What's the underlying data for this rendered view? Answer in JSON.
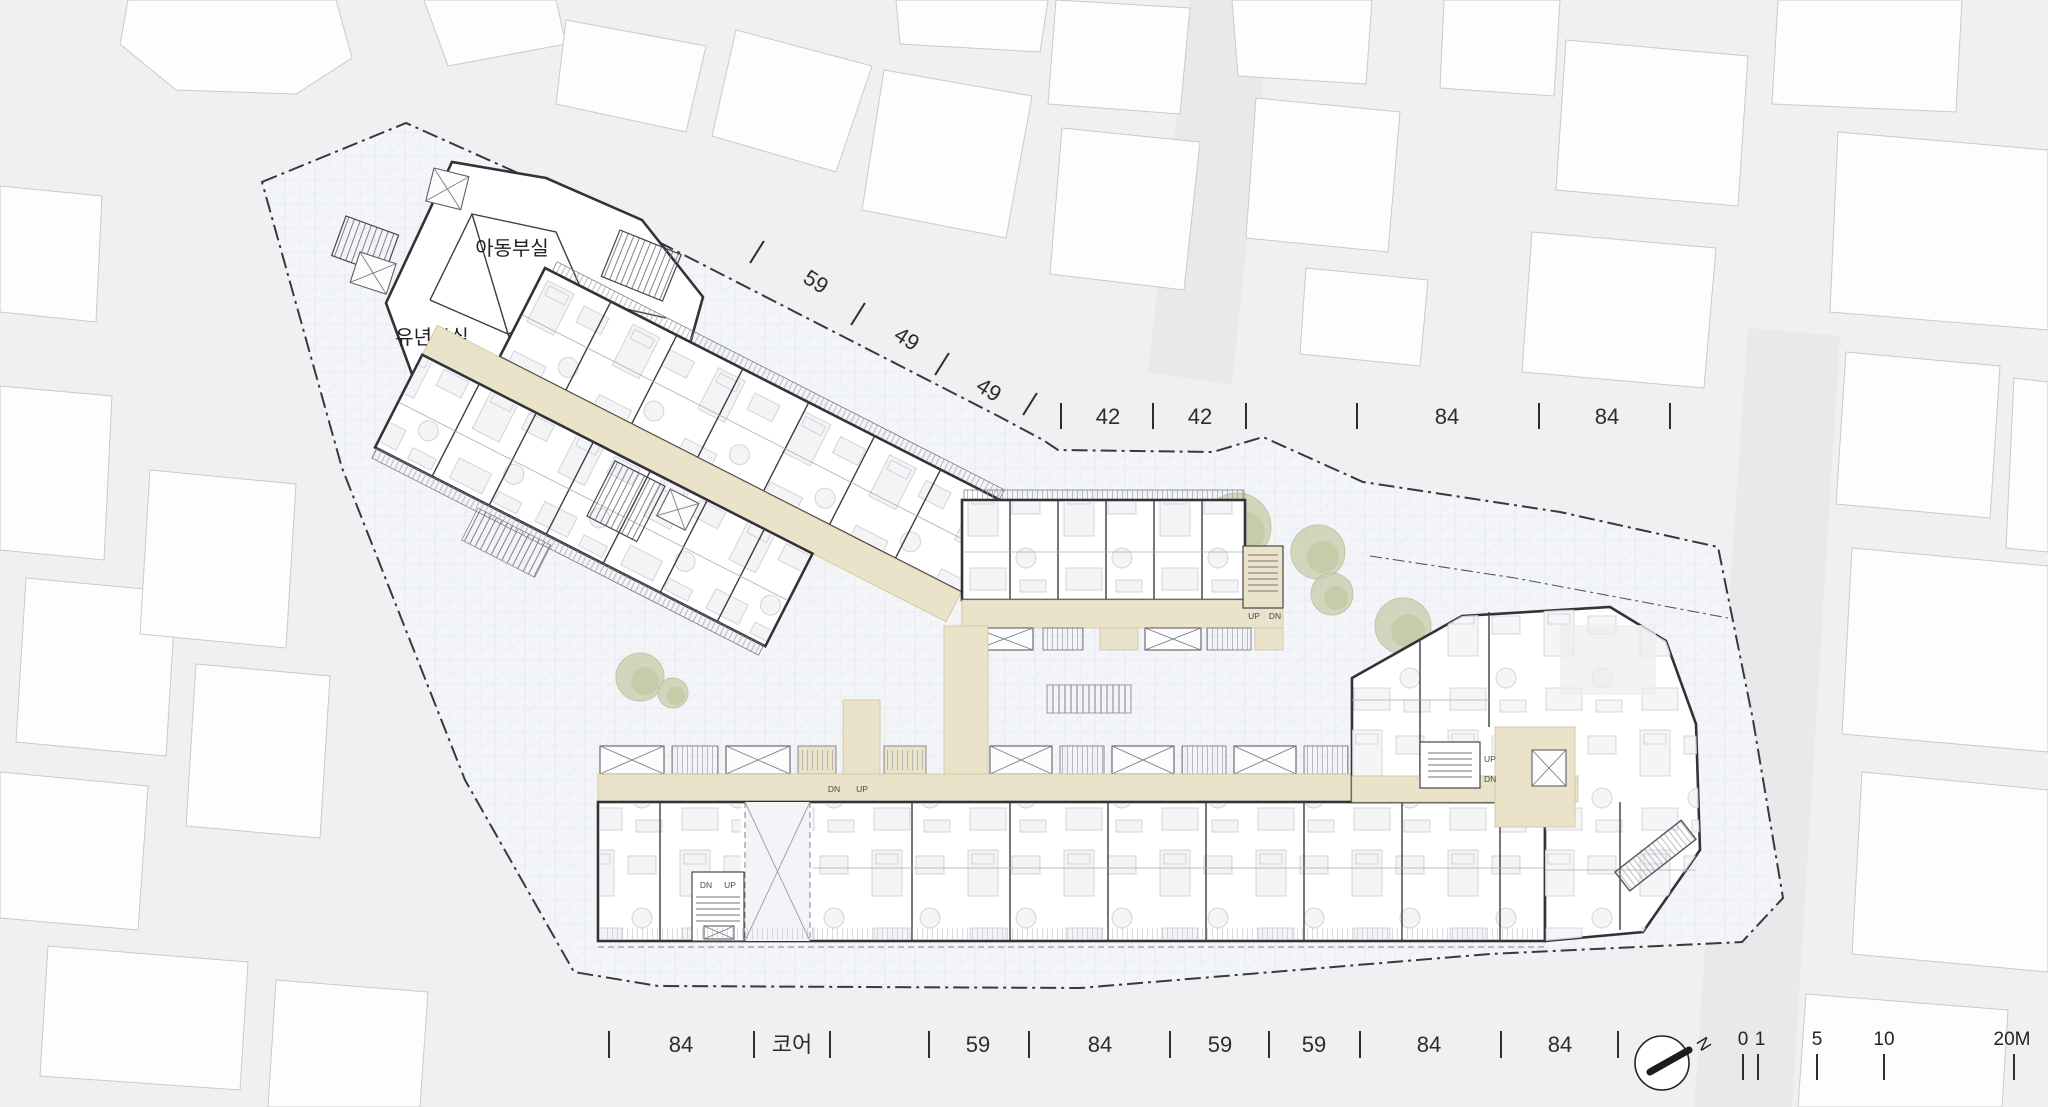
{
  "annex_rooms": {
    "children_room": "아동부실",
    "pastoral_room": "목양실",
    "infant_room": "유년부실",
    "youth_room": "청년부실"
  },
  "dims": {
    "top_diagonal": [
      "59",
      "49",
      "49"
    ],
    "top_horizontal": [
      "42",
      "42",
      "84",
      "84"
    ],
    "bottom": [
      "84",
      "코어",
      "59",
      "84",
      "59",
      "59",
      "84",
      "84"
    ]
  },
  "stairs": {
    "up": "UP",
    "dn": "DN"
  },
  "compass": {
    "north": "N"
  },
  "scale_bar": {
    "zero": "0",
    "one": "1",
    "five": "5",
    "ten": "10",
    "twenty": "20M"
  },
  "colors": {
    "corridor_beige": "#eae3c9",
    "wall_dark": "#323338",
    "tree_green": "#cbd2b2",
    "paving": "#f3f5f8",
    "boundary": "#38393d"
  }
}
